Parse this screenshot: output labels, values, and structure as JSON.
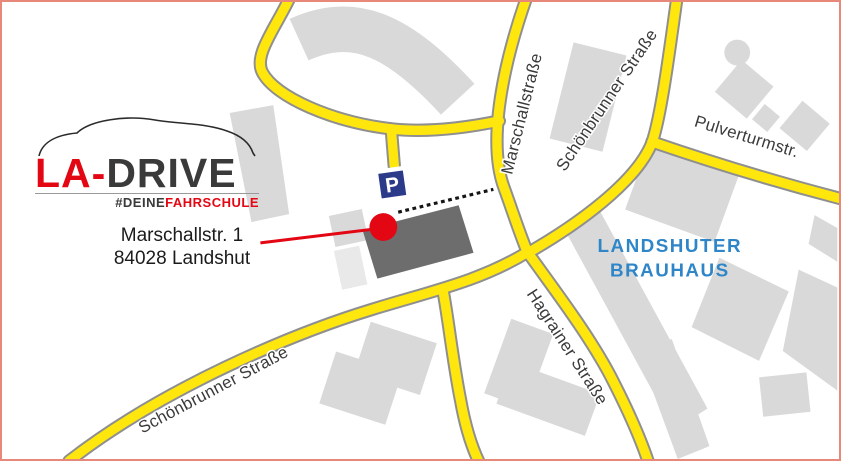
{
  "colors": {
    "road-yellow": "#ffe60d",
    "road-casing": "#8f8f8f",
    "building": "#d9d9d9",
    "building-light": "#e9e9e9",
    "building-dark": "#6d6d6d",
    "accent-red": "#e30613",
    "parking-blue": "#2c3a8a",
    "brauhaus-blue": "#2e86c9",
    "frame-border": "#e8887b",
    "label-dark": "#3a3a3a",
    "logo-dark": "#3a3a3a"
  },
  "logo": {
    "wordmark_red": "LA-",
    "wordmark_dark": "DRIVE",
    "tagline_dark": "#DEINE",
    "tagline_red": "FAHRSCHULE"
  },
  "address": {
    "line1": "Marschallstr. 1",
    "line2": "84028 Landshut"
  },
  "map": {
    "streets": {
      "marschallstrasse": "Marschallstraße",
      "schoenbrunner": "Schönbrunner Straße",
      "pulverturmstr": "Pulverturmstr.",
      "hagrainer": "Hagrainer Straße"
    },
    "poi": {
      "brauhaus_line1": "LANDSHUTER",
      "brauhaus_line2": "BRAUHAUS",
      "parking_label": "P"
    }
  }
}
